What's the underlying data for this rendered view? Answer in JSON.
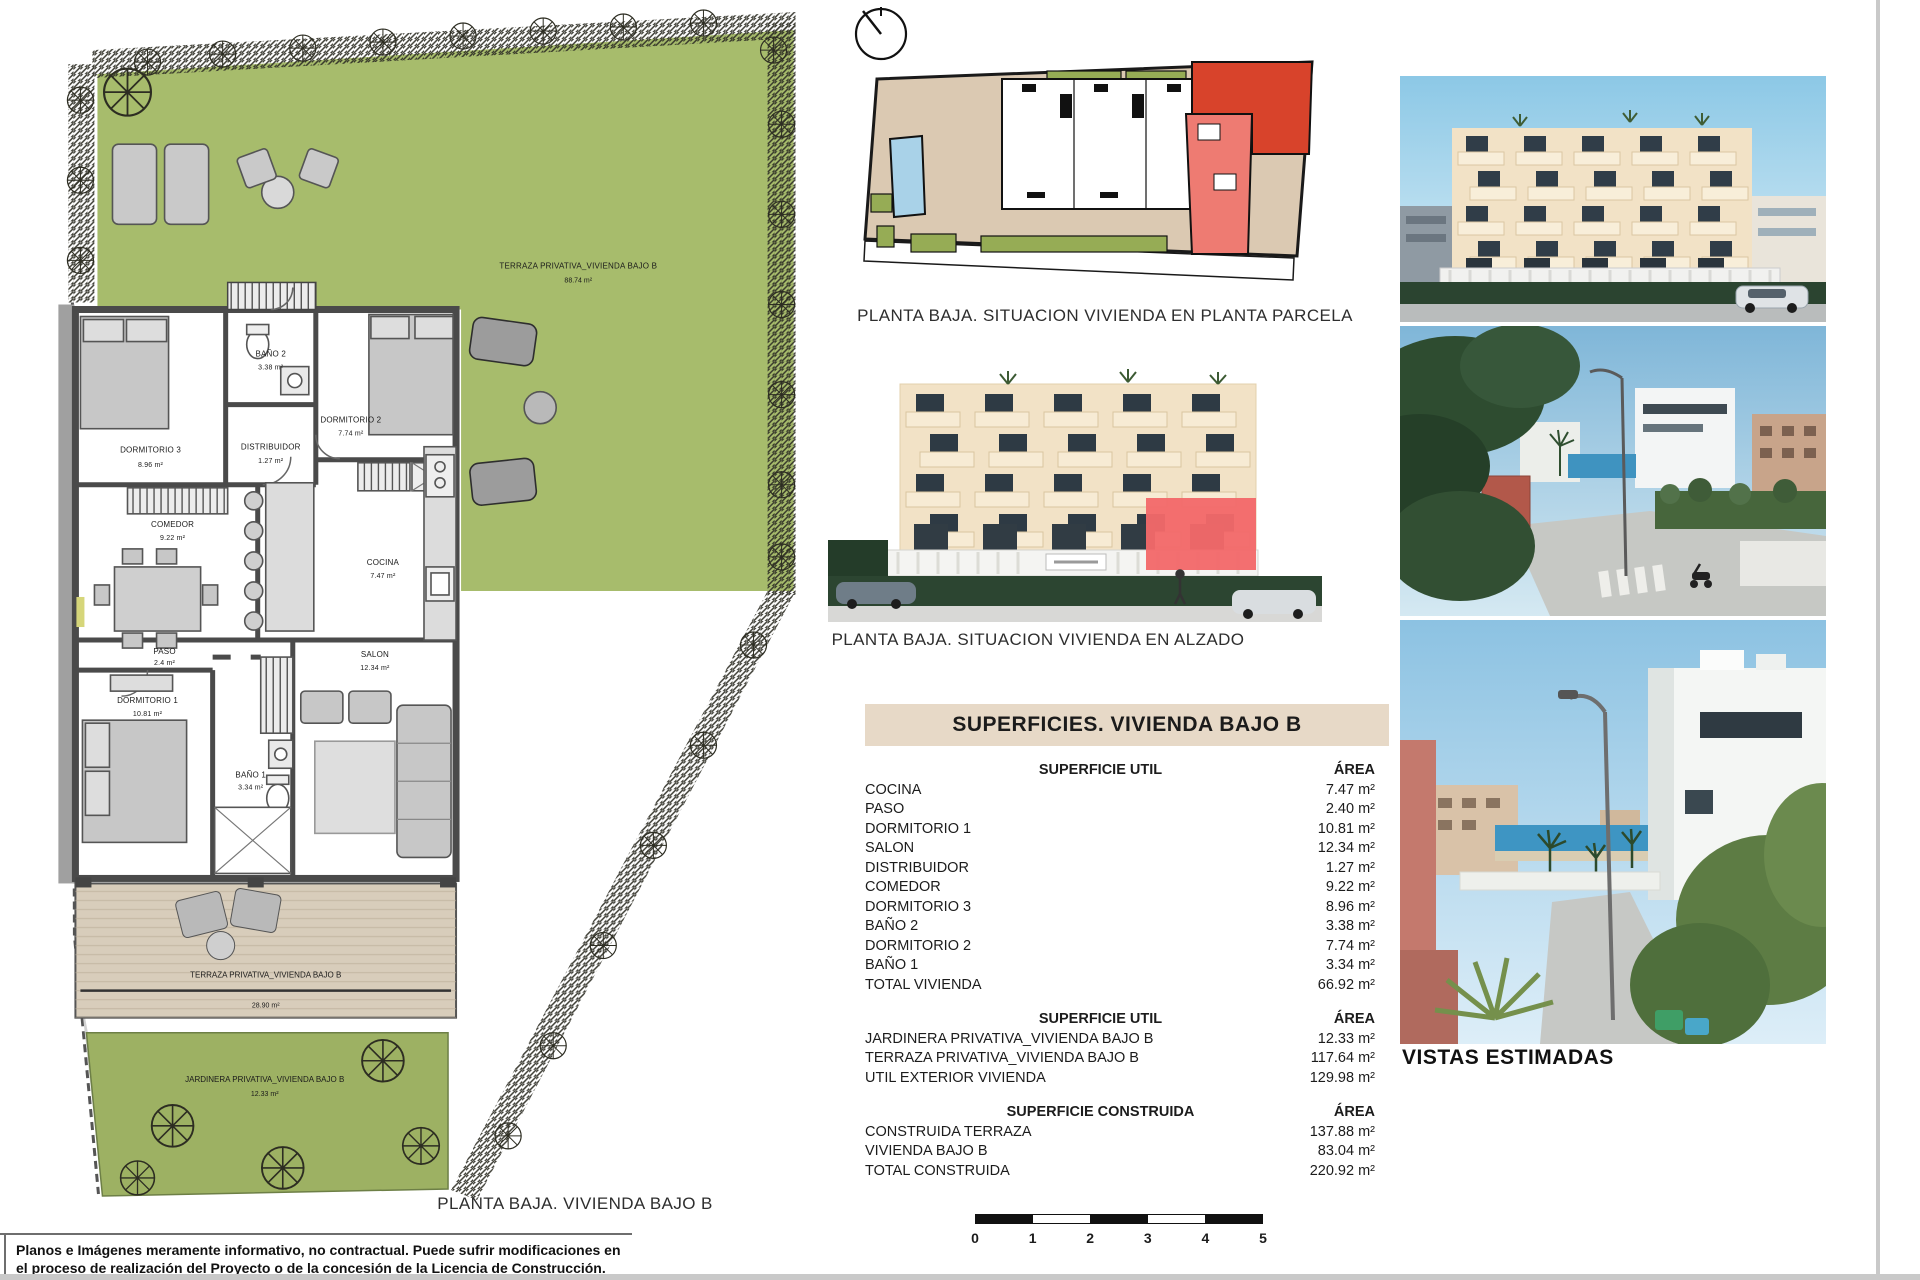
{
  "floor_plan": {
    "caption": "PLANTA BAJA. VIVIENDA BAJO B",
    "garden": {
      "label": "TERRAZA PRIVATIVA_VIVIENDA BAJO B",
      "area": "88.74 m²"
    },
    "terrace": {
      "label": "TERRAZA PRIVATIVA_VIVIENDA BAJO B",
      "area": "28.90 m²"
    },
    "jardinera": {
      "label": "JARDINERA PRIVATIVA_VIVIENDA BAJO B",
      "area": "12.33 m²"
    },
    "rooms": [
      {
        "name": "DORMITORIO 3",
        "area": "8.96 m²"
      },
      {
        "name": "BAÑO 2",
        "area": "3.38 m²"
      },
      {
        "name": "DORMITORIO 2",
        "area": "7.74 m²"
      },
      {
        "name": "DISTRIBUIDOR",
        "area": "1.27 m²"
      },
      {
        "name": "COMEDOR",
        "area": "9.22 m²"
      },
      {
        "name": "COCINA",
        "area": "7.47 m²"
      },
      {
        "name": "PASO",
        "area": "2.4 m²"
      },
      {
        "name": "SALON",
        "area": "12.34 m²"
      },
      {
        "name": "DORMITORIO 1",
        "area": "10.81 m²"
      },
      {
        "name": "BAÑO 1",
        "area": "3.34 m²"
      }
    ]
  },
  "site_plan": {
    "caption": "PLANTA BAJA. SITUACION VIVIENDA EN PLANTA PARCELA"
  },
  "elevation": {
    "caption": "PLANTA BAJA. SITUACION VIVIENDA EN ALZADO"
  },
  "surfaces_table": {
    "title": "SUPERFICIES. VIVIENDA BAJO B",
    "sections": [
      {
        "header": "SUPERFICIE UTIL",
        "area_header": "ÁREA",
        "rows": [
          {
            "label": "COCINA",
            "value": "7.47 m²"
          },
          {
            "label": "PASO",
            "value": "2.40 m²"
          },
          {
            "label": "DORMITORIO 1",
            "value": "10.81 m²"
          },
          {
            "label": "SALON",
            "value": "12.34 m²"
          },
          {
            "label": "DISTRIBUIDOR",
            "value": "1.27 m²"
          },
          {
            "label": "COMEDOR",
            "value": "9.22 m²"
          },
          {
            "label": "DORMITORIO 3",
            "value": "8.96 m²"
          },
          {
            "label": "BAÑO 2",
            "value": "3.38 m²"
          },
          {
            "label": "DORMITORIO 2",
            "value": "7.74 m²"
          },
          {
            "label": "BAÑO 1",
            "value": "3.34 m²"
          },
          {
            "label": "TOTAL VIVIENDA",
            "value": "66.92 m²"
          }
        ]
      },
      {
        "header": "SUPERFICIE UTIL",
        "area_header": "ÁREA",
        "rows": [
          {
            "label": "JARDINERA PRIVATIVA_VIVIENDA BAJO B",
            "value": "12.33 m²"
          },
          {
            "label": "TERRAZA PRIVATIVA_VIVIENDA BAJO B",
            "value": "117.64 m²"
          },
          {
            "label": "UTIL EXTERIOR VIVIENDA",
            "value": "129.98 m²"
          }
        ]
      },
      {
        "header": "SUPERFICIE CONSTRUIDA",
        "area_header": "ÁREA",
        "rows": [
          {
            "label": "CONSTRUIDA TERRAZA",
            "value": "137.88 m²"
          },
          {
            "label": "VIVIENDA BAJO B",
            "value": "83.04 m²"
          },
          {
            "label": "TOTAL CONSTRUIDA",
            "value": "220.92 m²"
          }
        ]
      }
    ]
  },
  "views": {
    "label": "VISTAS ESTIMADAS"
  },
  "scale_bar": {
    "ticks": [
      "0",
      "1",
      "2",
      "3",
      "4",
      "5"
    ]
  },
  "footer": {
    "disclaimer_line1": "Planos e Imágenes meramente informativo, no contractual. Puede sufrir modificaciones en",
    "disclaimer_line2": "el proceso de realización del Proyecto o de la concesión de la Licencia de Construcción."
  },
  "colors": {
    "garden_green": "#a7bc6c",
    "highlight_red": "#d8432b",
    "highlight_red_light": "#ee7b72",
    "pool_blue": "#a9d2e8",
    "table_header_bg": "#e7d9c7",
    "terrace_tan": "#d8cdbb"
  }
}
